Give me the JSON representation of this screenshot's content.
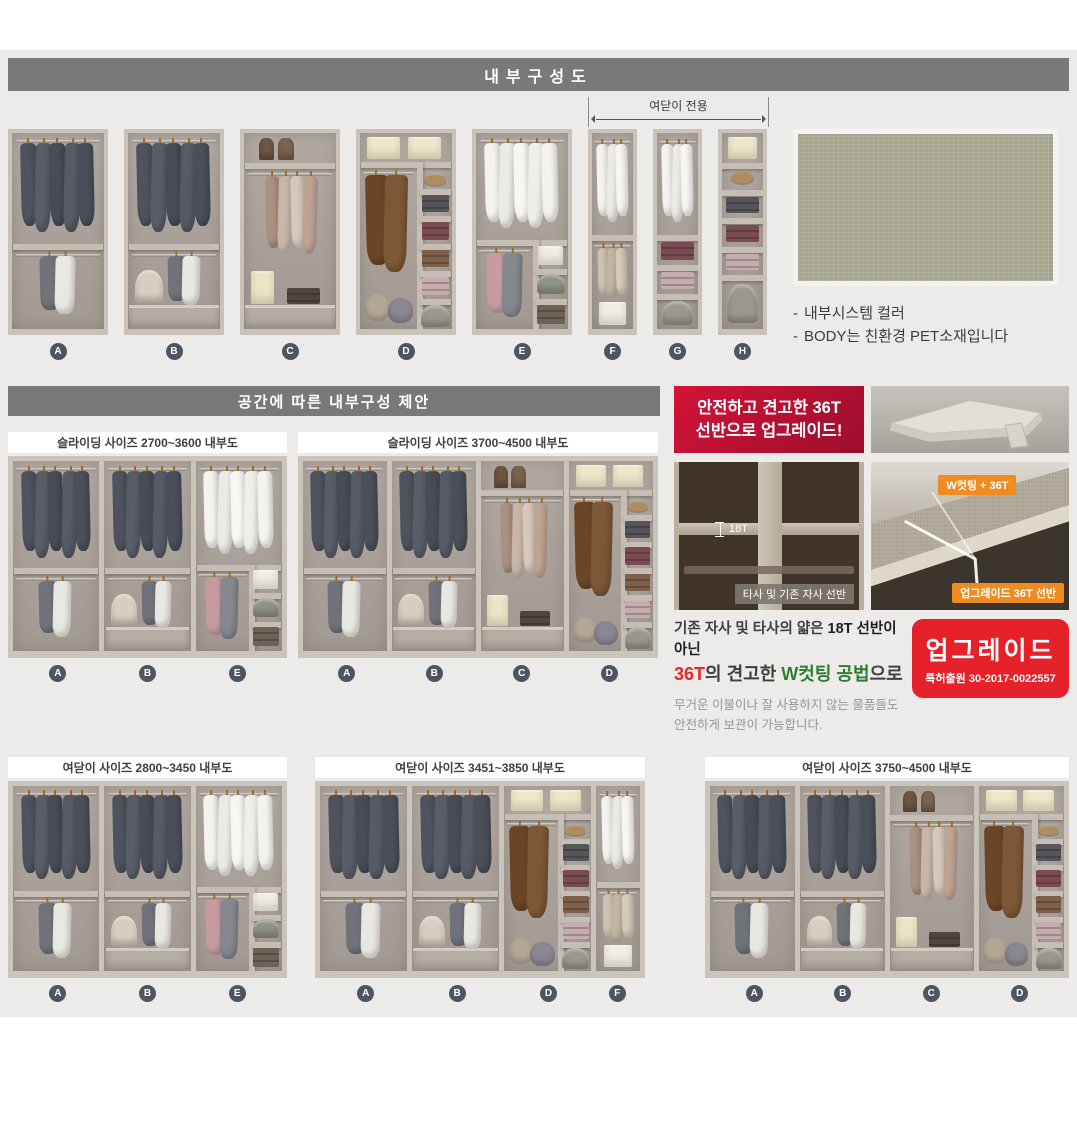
{
  "header": {
    "title": "내부구성도"
  },
  "top_row": {
    "bracket_label": "여닫이 전용",
    "modules": [
      "A",
      "B",
      "C",
      "D",
      "E",
      "F",
      "G",
      "H"
    ],
    "notes": [
      "내부시스템 컬러",
      "BODY는 친환경 PET소재입니다"
    ],
    "note_dash": "-"
  },
  "section2": {
    "title": "공간에 따른 내부구성 제안",
    "panels": [
      {
        "label": "슬라이딩 사이즈 2700~3600 내부도",
        "modules": [
          "A",
          "B",
          "E"
        ]
      },
      {
        "label": "슬라이딩 사이즈 3700~4500 내부도",
        "modules": [
          "A",
          "B",
          "C",
          "D"
        ]
      }
    ]
  },
  "section3": {
    "panels": [
      {
        "label": "여닫이 사이즈 2800~3450 내부도",
        "modules": [
          "A",
          "B",
          "E"
        ]
      },
      {
        "label": "여닫이 사이즈 3451~3850 내부도",
        "modules": [
          "A",
          "B",
          "D",
          "F"
        ]
      },
      {
        "label": "여닫이 사이즈 3750~4500 내부도",
        "modules": [
          "A",
          "B",
          "C",
          "D"
        ]
      }
    ]
  },
  "upgrade": {
    "badge_lines": [
      "안전하고 견고한 36T",
      "선반으로 업그레이드!"
    ],
    "thin_shelf_label": "18T",
    "thin_shelf_caption": "타사 및 기존 자사 선반",
    "thick_shelf_tag_top": "W컷팅 + 36T",
    "thick_shelf_tag_bottom": "업그레이드 36T 선반",
    "para_line1": [
      {
        "text": "기존 자사 및 타사의 얇은 ",
        "style": "normal"
      },
      {
        "text": "18T 선반이 아닌",
        "style": "bold"
      }
    ],
    "para_line2": [
      {
        "text": "36T",
        "style": "red"
      },
      {
        "text": "의 견고한 ",
        "style": "normal"
      },
      {
        "text": "W컷팅 공법",
        "style": "green"
      },
      {
        "text": "으로",
        "style": "normal"
      }
    ],
    "para_small": [
      "무거운 이불이나 잘 사용하지 않는 물품들도",
      "안전하게 보관이 가능합니다."
    ],
    "patent_title": "업그레이드",
    "patent_no": "특허출원 30-2017-0022557"
  },
  "colors": {
    "header_bar": "#7b7977",
    "accent_red": "#e62129",
    "badge_red_top": "#d41337",
    "badge_red_bottom": "#9c0e2e",
    "tag_orange": "#ef8b1f",
    "text_green": "#2e7d32",
    "letter_badge": "#4d5562",
    "swatch_sage": "#a5a48d",
    "frame_beige": "#c9c2b8",
    "interior_gray": "#a9a199"
  },
  "palettes": {
    "suits": [
      "#4e535d",
      "#585d67",
      "#474c56",
      "#555a64",
      "#4a4f59"
    ],
    "shirts": [
      "#f4f3f0",
      "#ebeae6",
      "#f7f6f3",
      "#efeeea",
      "#f3f2ef"
    ],
    "duo": [
      "#70737a",
      "#e9e7e2"
    ],
    "lights": [
      "#ab9180",
      "#c9b6a8",
      "#d7c8bc",
      "#bfa494"
    ],
    "coats": [
      "#6b4527",
      "#7c5836"
    ],
    "beiges": [
      "#cdc2b0",
      "#c2b6a3",
      "#d5cbba"
    ],
    "pinkgray": [
      "#c79ba0",
      "#85888e"
    ]
  },
  "wardrobe_modules": {
    "A": {
      "w": 1,
      "items": [
        {
          "t": "rod",
          "x": 0.04,
          "y": 0.035,
          "w": 0.92
        },
        {
          "t": "hang",
          "x": 0.1,
          "y": 0.05,
          "w": 0.8,
          "h": 0.46,
          "n": 5,
          "c": "suits"
        },
        {
          "t": "shelf",
          "y": 0.565
        },
        {
          "t": "rod",
          "x": 0.04,
          "y": 0.615,
          "w": 0.92
        },
        {
          "t": "hang",
          "x": 0.3,
          "y": 0.63,
          "w": 0.38,
          "h": 0.3,
          "n": 2,
          "c": "duo"
        }
      ]
    },
    "B": {
      "w": 1,
      "items": [
        {
          "t": "rod",
          "x": 0.04,
          "y": 0.035,
          "w": 0.92
        },
        {
          "t": "hang",
          "x": 0.1,
          "y": 0.05,
          "w": 0.8,
          "h": 0.46,
          "n": 5,
          "c": "suits"
        },
        {
          "t": "shelf",
          "y": 0.565
        },
        {
          "t": "rod",
          "x": 0.04,
          "y": 0.615,
          "w": 0.92
        },
        {
          "t": "hang",
          "x": 0.44,
          "y": 0.63,
          "w": 0.34,
          "h": 0.25,
          "n": 2,
          "c": "duo"
        },
        {
          "t": "round",
          "x": 0.08,
          "y": 0.7,
          "w": 0.3,
          "h": 0.165,
          "c": "#d6cfc0"
        },
        {
          "t": "drawer",
          "x": 0.015,
          "y": 0.875,
          "w": 0.97,
          "h": 0.115
        }
      ]
    },
    "C": {
      "w": 1,
      "items": [
        {
          "t": "bag",
          "x": 0.16,
          "y": 0.025,
          "w": 0.17,
          "h": 0.115,
          "c": "#6e5742"
        },
        {
          "t": "bag",
          "x": 0.37,
          "y": 0.025,
          "w": 0.17,
          "h": 0.115,
          "c": "#7a6350"
        },
        {
          "t": "shelf",
          "y": 0.155
        },
        {
          "t": "rod",
          "x": 0.04,
          "y": 0.205,
          "w": 0.92
        },
        {
          "t": "hang",
          "x": 0.24,
          "y": 0.22,
          "w": 0.56,
          "h": 0.4,
          "n": 4,
          "c": "lights"
        },
        {
          "t": "box",
          "x": 0.08,
          "y": 0.705,
          "w": 0.25,
          "h": 0.165,
          "c": "#ece4c6"
        },
        {
          "t": "stack",
          "x": 0.47,
          "y": 0.79,
          "w": 0.36,
          "h": 0.08,
          "c": "#4f473f"
        },
        {
          "t": "drawer",
          "x": 0.015,
          "y": 0.875,
          "w": 0.97,
          "h": 0.115
        }
      ]
    },
    "D": {
      "w": 1,
      "items": [
        {
          "t": "box",
          "x": 0.08,
          "y": 0.02,
          "w": 0.36,
          "h": 0.115,
          "c": "#efe7c9"
        },
        {
          "t": "box",
          "x": 0.52,
          "y": 0.02,
          "w": 0.36,
          "h": 0.115,
          "c": "#efe7c9"
        },
        {
          "t": "shelf",
          "y": 0.15
        },
        {
          "t": "vdiv",
          "x": 0.62,
          "y": 0.15,
          "h": 0.85
        },
        {
          "t": "rod",
          "x": 0.03,
          "y": 0.2,
          "w": 0.56
        },
        {
          "t": "hang",
          "x": 0.07,
          "y": 0.215,
          "w": 0.44,
          "h": 0.5,
          "n": 2,
          "c": "coats"
        },
        {
          "t": "pillow",
          "x": 0.05,
          "y": 0.82,
          "w": 0.28,
          "h": 0.14,
          "c": "#b4a795"
        },
        {
          "t": "pillow",
          "x": 0.3,
          "y": 0.84,
          "w": 0.28,
          "h": 0.13,
          "c": "#8a8792"
        },
        {
          "t": "shelf",
          "x": 0.655,
          "y": 0.285,
          "w": 0.33
        },
        {
          "t": "shelf",
          "x": 0.655,
          "y": 0.425,
          "w": 0.33
        },
        {
          "t": "shelf",
          "x": 0.655,
          "y": 0.565,
          "w": 0.33
        },
        {
          "t": "shelf",
          "x": 0.655,
          "y": 0.705,
          "w": 0.33
        },
        {
          "t": "shelf",
          "x": 0.655,
          "y": 0.845,
          "w": 0.33
        },
        {
          "t": "hat",
          "x": 0.7,
          "y": 0.215,
          "w": 0.24,
          "h": 0.05
        },
        {
          "t": "stack",
          "x": 0.67,
          "y": 0.315,
          "w": 0.3,
          "h": 0.09,
          "c": "#55555a"
        },
        {
          "t": "stack",
          "x": 0.67,
          "y": 0.455,
          "w": 0.3,
          "h": 0.09,
          "c": "#7b4b53"
        },
        {
          "t": "stack",
          "x": 0.67,
          "y": 0.595,
          "w": 0.3,
          "h": 0.09,
          "c": "#7d5f4a"
        },
        {
          "t": "stack",
          "x": 0.67,
          "y": 0.735,
          "w": 0.3,
          "h": 0.09,
          "c": "#c6abaf"
        },
        {
          "t": "round",
          "x": 0.665,
          "y": 0.875,
          "w": 0.31,
          "h": 0.115,
          "c": "#9b968f"
        }
      ]
    },
    "E": {
      "w": 1,
      "items": [
        {
          "t": "rod",
          "x": 0.04,
          "y": 0.035,
          "w": 0.92
        },
        {
          "t": "hang",
          "x": 0.1,
          "y": 0.05,
          "w": 0.8,
          "h": 0.44,
          "n": 5,
          "c": "shirts"
        },
        {
          "t": "shelf",
          "y": 0.545
        },
        {
          "t": "vdiv",
          "x": 0.62,
          "y": 0.545,
          "h": 0.455
        },
        {
          "t": "rod",
          "x": 0.03,
          "y": 0.595,
          "w": 0.56
        },
        {
          "t": "hang",
          "x": 0.12,
          "y": 0.61,
          "w": 0.38,
          "h": 0.33,
          "n": 2,
          "c": "pinkgray"
        },
        {
          "t": "box",
          "x": 0.67,
          "y": 0.575,
          "w": 0.28,
          "h": 0.1,
          "c": "#f0ede6"
        },
        {
          "t": "shelf",
          "x": 0.655,
          "y": 0.695,
          "w": 0.33
        },
        {
          "t": "round",
          "x": 0.665,
          "y": 0.72,
          "w": 0.3,
          "h": 0.1,
          "c": "#8f9383"
        },
        {
          "t": "shelf",
          "x": 0.655,
          "y": 0.845,
          "w": 0.33
        },
        {
          "t": "stack",
          "x": 0.665,
          "y": 0.875,
          "w": 0.3,
          "h": 0.1,
          "c": "#6e6257"
        }
      ]
    },
    "F": {
      "w": 0.5,
      "items": [
        {
          "t": "rod",
          "x": 0.06,
          "y": 0.04,
          "w": 0.88
        },
        {
          "t": "hang",
          "x": 0.12,
          "y": 0.055,
          "w": 0.76,
          "h": 0.4,
          "n": 3,
          "c": "shirts"
        },
        {
          "t": "shelf",
          "y": 0.52
        },
        {
          "t": "rod",
          "x": 0.06,
          "y": 0.57,
          "w": 0.88
        },
        {
          "t": "hang",
          "x": 0.14,
          "y": 0.585,
          "w": 0.72,
          "h": 0.26,
          "n": 3,
          "c": "beiges"
        },
        {
          "t": "box",
          "x": 0.18,
          "y": 0.86,
          "w": 0.64,
          "h": 0.12,
          "c": "#f0ede6"
        }
      ]
    },
    "G": {
      "w": 0.5,
      "items": [
        {
          "t": "rod",
          "x": 0.06,
          "y": 0.04,
          "w": 0.88
        },
        {
          "t": "hang",
          "x": 0.12,
          "y": 0.055,
          "w": 0.76,
          "h": 0.4,
          "n": 3,
          "c": "shirts"
        },
        {
          "t": "shelf",
          "y": 0.52
        },
        {
          "t": "stack",
          "x": 0.1,
          "y": 0.555,
          "w": 0.8,
          "h": 0.095,
          "c": "#7b4b53"
        },
        {
          "t": "shelf",
          "y": 0.675
        },
        {
          "t": "stack",
          "x": 0.1,
          "y": 0.71,
          "w": 0.8,
          "h": 0.085,
          "c": "#c6abaf"
        },
        {
          "t": "shelf",
          "y": 0.82
        },
        {
          "t": "round",
          "x": 0.12,
          "y": 0.855,
          "w": 0.76,
          "h": 0.125,
          "c": "#9b968f"
        }
      ]
    },
    "H": {
      "w": 0.5,
      "items": [
        {
          "t": "box",
          "x": 0.14,
          "y": 0.02,
          "w": 0.72,
          "h": 0.115,
          "c": "#efe7c9"
        },
        {
          "t": "shelf",
          "y": 0.155
        },
        {
          "t": "hat",
          "x": 0.22,
          "y": 0.2,
          "w": 0.56,
          "h": 0.055
        },
        {
          "t": "shelf",
          "y": 0.29
        },
        {
          "t": "stack",
          "x": 0.1,
          "y": 0.325,
          "w": 0.8,
          "h": 0.085,
          "c": "#55555a"
        },
        {
          "t": "shelf",
          "y": 0.435
        },
        {
          "t": "stack",
          "x": 0.1,
          "y": 0.47,
          "w": 0.8,
          "h": 0.085,
          "c": "#7b4b53"
        },
        {
          "t": "shelf",
          "y": 0.58
        },
        {
          "t": "stack",
          "x": 0.1,
          "y": 0.615,
          "w": 0.8,
          "h": 0.085,
          "c": "#c6abaf"
        },
        {
          "t": "shelf",
          "y": 0.725
        },
        {
          "t": "round",
          "x": 0.12,
          "y": 0.77,
          "w": 0.76,
          "h": 0.2,
          "c": "#9b968f"
        }
      ]
    }
  }
}
